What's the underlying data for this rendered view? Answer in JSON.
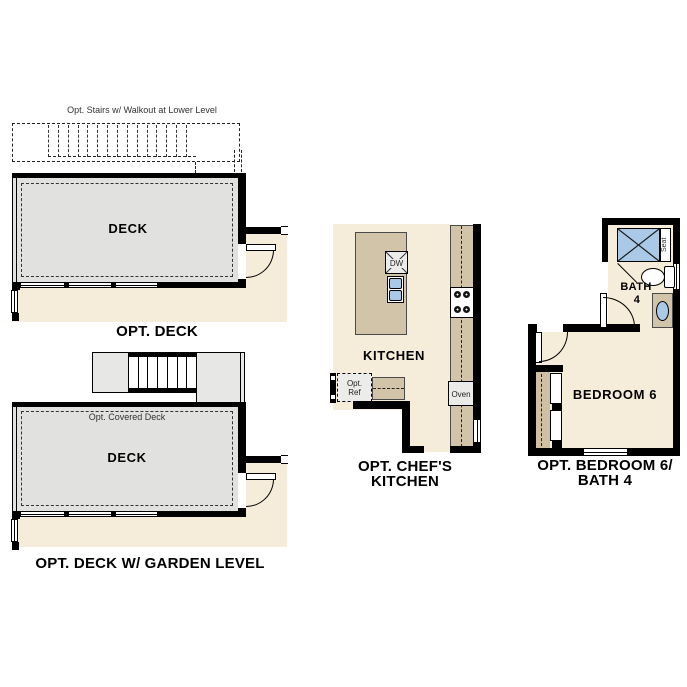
{
  "colors": {
    "floor_beige": "#f5ecd9",
    "deck_gray": "#e1e1df",
    "stair_gray": "#e7e7e5",
    "counter_tan": "#d2c4a8",
    "closet_tan": "#cfc0a4",
    "fixture_blue": "#a9c9e6",
    "appliance_gray": "#ebebe9",
    "wall_black": "#000000"
  },
  "plans": {
    "opt_deck": {
      "stairs_note": "Opt. Stairs w/ Walkout at Lower Level",
      "room_label": "DECK",
      "caption": "OPT. DECK"
    },
    "opt_deck_garden": {
      "covered_note": "Opt. Covered Deck",
      "room_label": "DECK",
      "caption": "OPT. DECK W/ GARDEN LEVEL"
    },
    "opt_chefs_kitchen": {
      "room_label": "KITCHEN",
      "dishwasher_label": "DW",
      "oven_label": "Oven",
      "ref_line1": "Opt.",
      "ref_line2": "Ref",
      "caption_line1": "OPT. CHEF'S",
      "caption_line2": "KITCHEN"
    },
    "opt_bedroom6_bath4": {
      "bath_label": "BATH",
      "bath_number": "4",
      "seat_label": "Seat",
      "room_label": "BEDROOM 6",
      "caption_line1": "OPT. BEDROOM 6/",
      "caption_line2": "BATH 4"
    }
  }
}
